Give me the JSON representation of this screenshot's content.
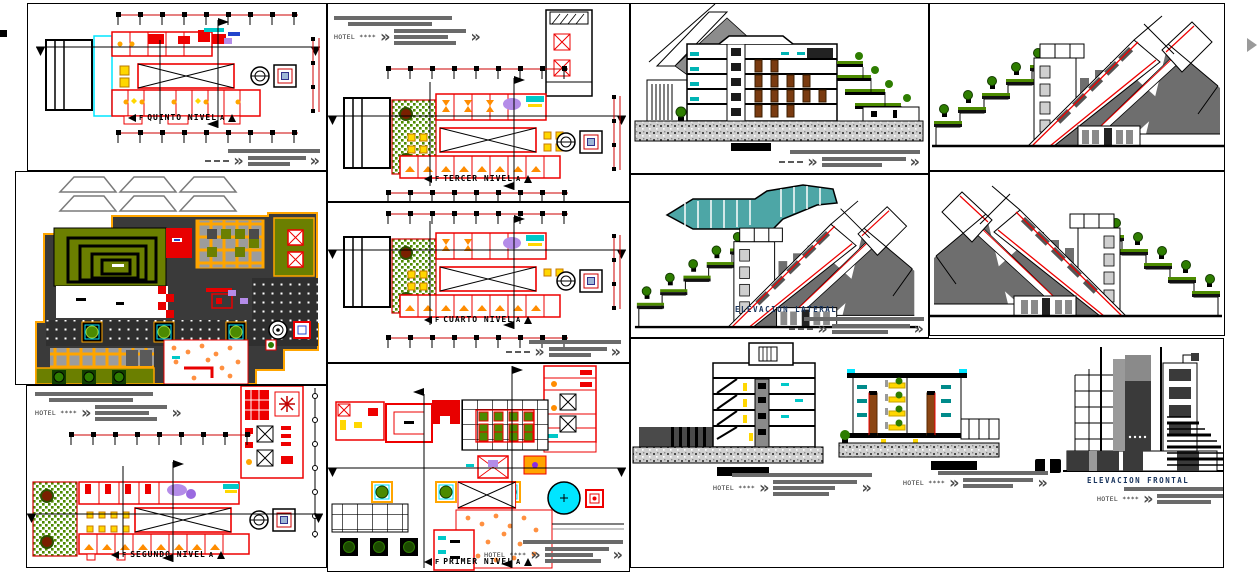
{
  "sheet": {
    "hotel_title": "HOTEL ****",
    "chevron": "»",
    "section_marker_left": "F",
    "section_marker_right": "A",
    "panels": {
      "quinto": {
        "label": "QUINTO NIVEL"
      },
      "tercer": {
        "label": "TERCER NIVEL"
      },
      "cuarto": {
        "label": "CUARTO NIVEL"
      },
      "segundo": {
        "label": "SEGUNDO NIVEL"
      },
      "primer": {
        "label": "PRIMER NIVEL"
      },
      "lateral": {
        "label": "ELEVACION LATERAL"
      },
      "frontal": {
        "label": "ELEVACION FRONTAL"
      }
    },
    "colors": {
      "cad_red": "#ee0000",
      "olive_green": "#6b7f00",
      "terrace_green": "#4c8a00",
      "tree_green": "#2e7d00",
      "site_orange": "#ffa500",
      "dark_gray": "#3a3a3a",
      "annotation_gray": "#6a6a6a",
      "teal_pool": "#4da6a6",
      "cyan_accent": "#00e5ff",
      "door_brown": "#7a3b10",
      "furniture_yellow": "#ffd700",
      "label_navy": "#16325c"
    }
  }
}
